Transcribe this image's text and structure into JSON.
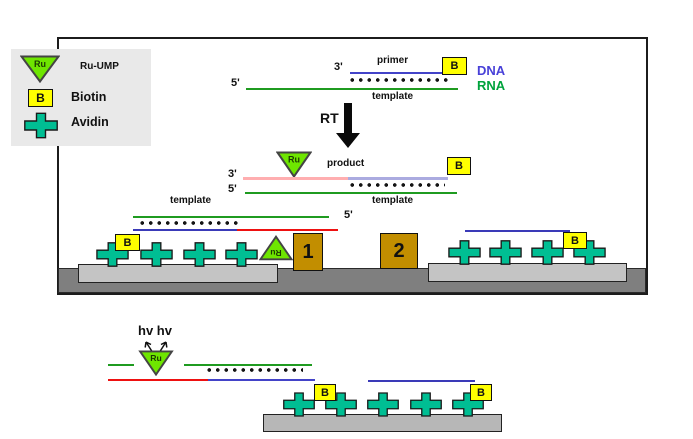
{
  "legend": {
    "ru_symbol": "Ru",
    "ru_label": "Ru-UMP",
    "biotin_symbol": "B",
    "biotin_label": "Biotin",
    "avidin_label": "Avidin"
  },
  "top_duplex": {
    "three_prime": "3'",
    "five_prime": "5'",
    "primer_label": "primer",
    "template_label": "template",
    "biotin_symbol": "B",
    "dna_label": "DNA",
    "rna_label": "RNA"
  },
  "rt_step": {
    "label": "RT"
  },
  "product_duplex": {
    "ru_symbol": "Ru",
    "product_label": "product",
    "biotin_symbol": "B",
    "three_prime": "3'",
    "five_prime": "5'",
    "template_label": "template"
  },
  "capture_left": {
    "template_label": "template",
    "five_prime": "5'",
    "biotin_symbol": "B",
    "ru_symbol": "Ru"
  },
  "electrodes": {
    "label_1": "1",
    "label_2": "2"
  },
  "capture_right": {
    "biotin_symbol": "B"
  },
  "detection": {
    "hv_label": "hv hv",
    "ru_symbol": "Ru",
    "biotin_symbol_1": "B",
    "biotin_symbol_2": "B"
  },
  "colors": {
    "ru_triangle_green": "#6ee600",
    "biotin_yellow": "#ffff00",
    "avidin_teal": "#00be93",
    "electrode_gold": "#c28e00",
    "dna_line_blue": "#4343c8",
    "rna_line_green": "#1f9b20",
    "product_line_pink": "#ffaeb0",
    "product_line_lavender": "#ababe0",
    "surface_strand_red": "#ee1111",
    "dna_text_blue": "#4840d8",
    "rna_text_green": "#00a33c",
    "platform_light_gray": "#c4c4c4",
    "base_bar_gray": "#7f7f7f",
    "legend_bg": "#e9e9e9"
  }
}
